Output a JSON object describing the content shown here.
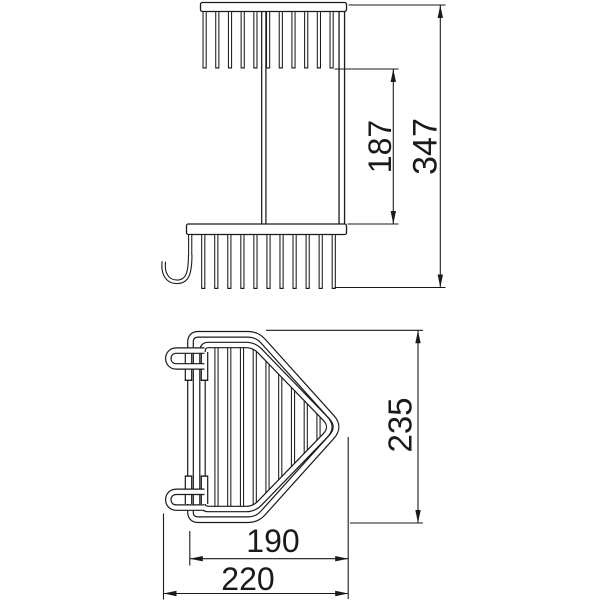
{
  "drawing": {
    "description": "two-tier corner wire basket technical drawing, front view and top view",
    "line_color": "#1a1a1a",
    "background": "#ffffff",
    "dimensions": {
      "shelf_spacing": "187",
      "overall_height": "347",
      "basket_depth": "235",
      "basket_width": "190",
      "overall_width": "220"
    }
  }
}
